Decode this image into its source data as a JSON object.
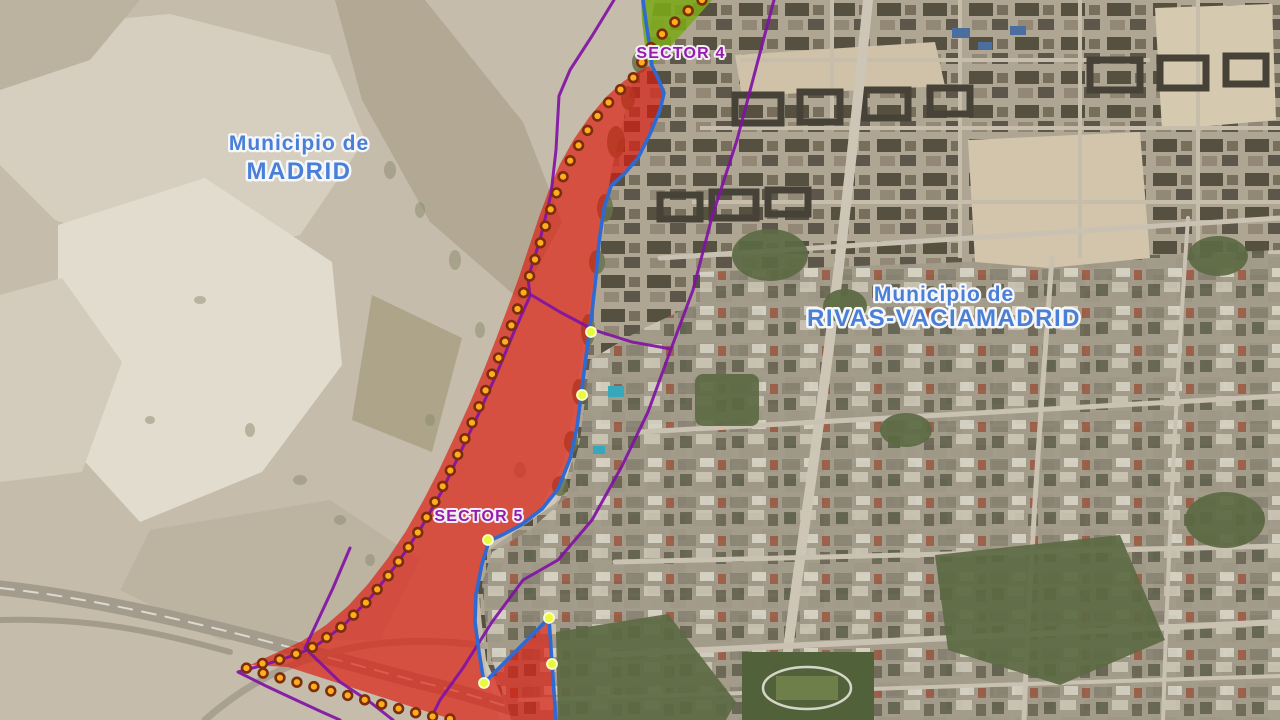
{
  "map": {
    "labels": {
      "municipality_left": {
        "line1": "Municipio de",
        "line2": "MADRID",
        "x": 299,
        "y1": 150,
        "y2": 179
      },
      "municipality_right": {
        "line1": "Municipio de",
        "line2": "RIVAS-VACIAMADRID",
        "x": 944,
        "y1": 301,
        "y2": 326
      },
      "sector4": {
        "text": "SECTOR 4",
        "x": 681,
        "y": 58
      },
      "sector5": {
        "text": "SECTOR 5",
        "x": 479,
        "y": 521
      }
    },
    "colors": {
      "municipality_label": "#4a7fd8",
      "sector_label": "#951bae",
      "red_zone_fill": "rgba(221,25,12,0.66)",
      "green_zone_fill": "rgba(124,168,24,0.88)",
      "boundary_blue": "#2f6ad2",
      "sector_line_purple": "#8012a4",
      "marker_dot_fill": "#ffad1f",
      "marker_dot_ring": "#7c2d0a",
      "vertex_dot_fill": "#e9fa3d",
      "vertex_dot_ring": "#fdfdd0"
    },
    "overlays": {
      "green_zone": [
        [
          641,
          0
        ],
        [
          712,
          0
        ],
        [
          697,
          17
        ],
        [
          678,
          38
        ],
        [
          660,
          57
        ],
        [
          650,
          68
        ],
        [
          645,
          46
        ],
        [
          642,
          22
        ]
      ],
      "red_zone": [
        [
          649,
          66
        ],
        [
          658,
          78
        ],
        [
          664,
          93
        ],
        [
          660,
          110
        ],
        [
          650,
          134
        ],
        [
          638,
          158
        ],
        [
          625,
          173
        ],
        [
          611,
          186
        ],
        [
          604,
          208
        ],
        [
          599,
          242
        ],
        [
          596,
          276
        ],
        [
          592,
          312
        ],
        [
          589,
          334
        ],
        [
          585,
          364
        ],
        [
          581,
          396
        ],
        [
          577,
          427
        ],
        [
          570,
          459
        ],
        [
          558,
          489
        ],
        [
          542,
          509
        ],
        [
          521,
          525
        ],
        [
          502,
          535
        ],
        [
          489,
          541
        ],
        [
          482,
          564
        ],
        [
          476,
          594
        ],
        [
          475,
          622
        ],
        [
          479,
          652
        ],
        [
          484,
          683
        ],
        [
          549,
          618
        ],
        [
          552,
          664
        ],
        [
          556,
          720
        ],
        [
          455,
          720
        ],
        [
          428,
          712
        ],
        [
          400,
          703
        ],
        [
          372,
          694
        ],
        [
          344,
          685
        ],
        [
          316,
          676
        ],
        [
          288,
          667
        ],
        [
          250,
          665
        ],
        [
          276,
          653
        ],
        [
          302,
          641
        ],
        [
          326,
          625
        ],
        [
          348,
          606
        ],
        [
          368,
          584
        ],
        [
          388,
          558
        ],
        [
          406,
          531
        ],
        [
          423,
          501
        ],
        [
          439,
          470
        ],
        [
          454,
          438
        ],
        [
          469,
          405
        ],
        [
          483,
          372
        ],
        [
          496,
          339
        ],
        [
          508,
          307
        ],
        [
          519,
          277
        ],
        [
          529,
          247
        ],
        [
          539,
          217
        ],
        [
          549,
          190
        ],
        [
          560,
          164
        ],
        [
          574,
          139
        ],
        [
          590,
          116
        ],
        [
          607,
          96
        ],
        [
          624,
          81
        ],
        [
          637,
          72
        ]
      ],
      "blue_boundary": [
        [
          643,
          0
        ],
        [
          646,
          22
        ],
        [
          650,
          48
        ],
        [
          652,
          66
        ],
        [
          658,
          78
        ],
        [
          664,
          93
        ],
        [
          660,
          110
        ],
        [
          650,
          134
        ],
        [
          638,
          158
        ],
        [
          625,
          173
        ],
        [
          611,
          186
        ],
        [
          604,
          208
        ],
        [
          599,
          242
        ],
        [
          596,
          276
        ],
        [
          592,
          312
        ],
        [
          589,
          334
        ],
        [
          585,
          364
        ],
        [
          581,
          396
        ],
        [
          577,
          427
        ],
        [
          570,
          459
        ],
        [
          558,
          489
        ],
        [
          542,
          509
        ],
        [
          521,
          525
        ],
        [
          502,
          535
        ],
        [
          489,
          541
        ],
        [
          482,
          564
        ],
        [
          476,
          594
        ],
        [
          475,
          622
        ],
        [
          479,
          652
        ],
        [
          484,
          683
        ],
        [
          549,
          618
        ],
        [
          552,
          664
        ],
        [
          556,
          720
        ]
      ],
      "purple_lines": [
        [
          [
            614,
            0
          ],
          [
            592,
            36
          ],
          [
            570,
            70
          ],
          [
            559,
            96
          ],
          [
            556,
            150
          ],
          [
            551,
            194
          ],
          [
            540,
            240
          ],
          [
            528,
            278
          ],
          [
            530,
            296
          ],
          [
            514,
            332
          ],
          [
            497,
            373
          ],
          [
            479,
            413
          ],
          [
            461,
            451
          ],
          [
            442,
            491
          ],
          [
            421,
            528
          ],
          [
            397,
            564
          ],
          [
            371,
            597
          ],
          [
            343,
            626
          ],
          [
            313,
            648
          ],
          [
            286,
            658
          ],
          [
            260,
            666
          ],
          [
            238,
            672
          ],
          [
            266,
            686
          ],
          [
            296,
            700
          ],
          [
            322,
            712
          ],
          [
            340,
            720
          ]
        ],
        [
          [
            774,
            0
          ],
          [
            737,
            140
          ],
          [
            712,
            217
          ],
          [
            693,
            290
          ],
          [
            671,
            349
          ],
          [
            648,
            412
          ],
          [
            622,
            466
          ],
          [
            592,
            520
          ],
          [
            558,
            560
          ],
          [
            523,
            580
          ],
          [
            492,
            622
          ],
          [
            463,
            668
          ],
          [
            440,
            700
          ],
          [
            430,
            720
          ]
        ],
        [
          [
            528,
            293
          ],
          [
            560,
            312
          ],
          [
            594,
            330
          ],
          [
            632,
            342
          ],
          [
            671,
            349
          ]
        ],
        [
          [
            350,
            548
          ],
          [
            333,
            588
          ],
          [
            305,
            648
          ],
          [
            340,
            682
          ],
          [
            370,
            702
          ],
          [
            393,
            720
          ]
        ]
      ],
      "marker_chain": [
        [
          702,
          0
        ],
        [
          689,
          10
        ],
        [
          676,
          21
        ],
        [
          663,
          33
        ],
        [
          652,
          46
        ],
        [
          643,
          60
        ],
        [
          634,
          77
        ],
        [
          618,
          92
        ],
        [
          601,
          111
        ],
        [
          585,
          134
        ],
        [
          571,
          159
        ],
        [
          559,
          186
        ],
        [
          549,
          214
        ],
        [
          540,
          244
        ],
        [
          530,
          275
        ],
        [
          519,
          305
        ],
        [
          507,
          337
        ],
        [
          494,
          369
        ],
        [
          481,
          402
        ],
        [
          467,
          434
        ],
        [
          453,
          465
        ],
        [
          438,
          496
        ],
        [
          422,
          526
        ],
        [
          404,
          554
        ],
        [
          386,
          579
        ],
        [
          364,
          605
        ],
        [
          340,
          628
        ],
        [
          313,
          647
        ],
        [
          286,
          658
        ],
        [
          260,
          664
        ],
        [
          246,
          668
        ],
        [
          273,
          676
        ],
        [
          300,
          683
        ],
        [
          327,
          690
        ],
        [
          354,
          697
        ],
        [
          381,
          704
        ],
        [
          408,
          711
        ],
        [
          435,
          717
        ],
        [
          458,
          720
        ]
      ],
      "marker_spacing": 17.5,
      "vertex_dots": [
        [
          591,
          332
        ],
        [
          582,
          395
        ],
        [
          488,
          540
        ],
        [
          484,
          683
        ],
        [
          549,
          618
        ],
        [
          552,
          664
        ]
      ]
    }
  }
}
